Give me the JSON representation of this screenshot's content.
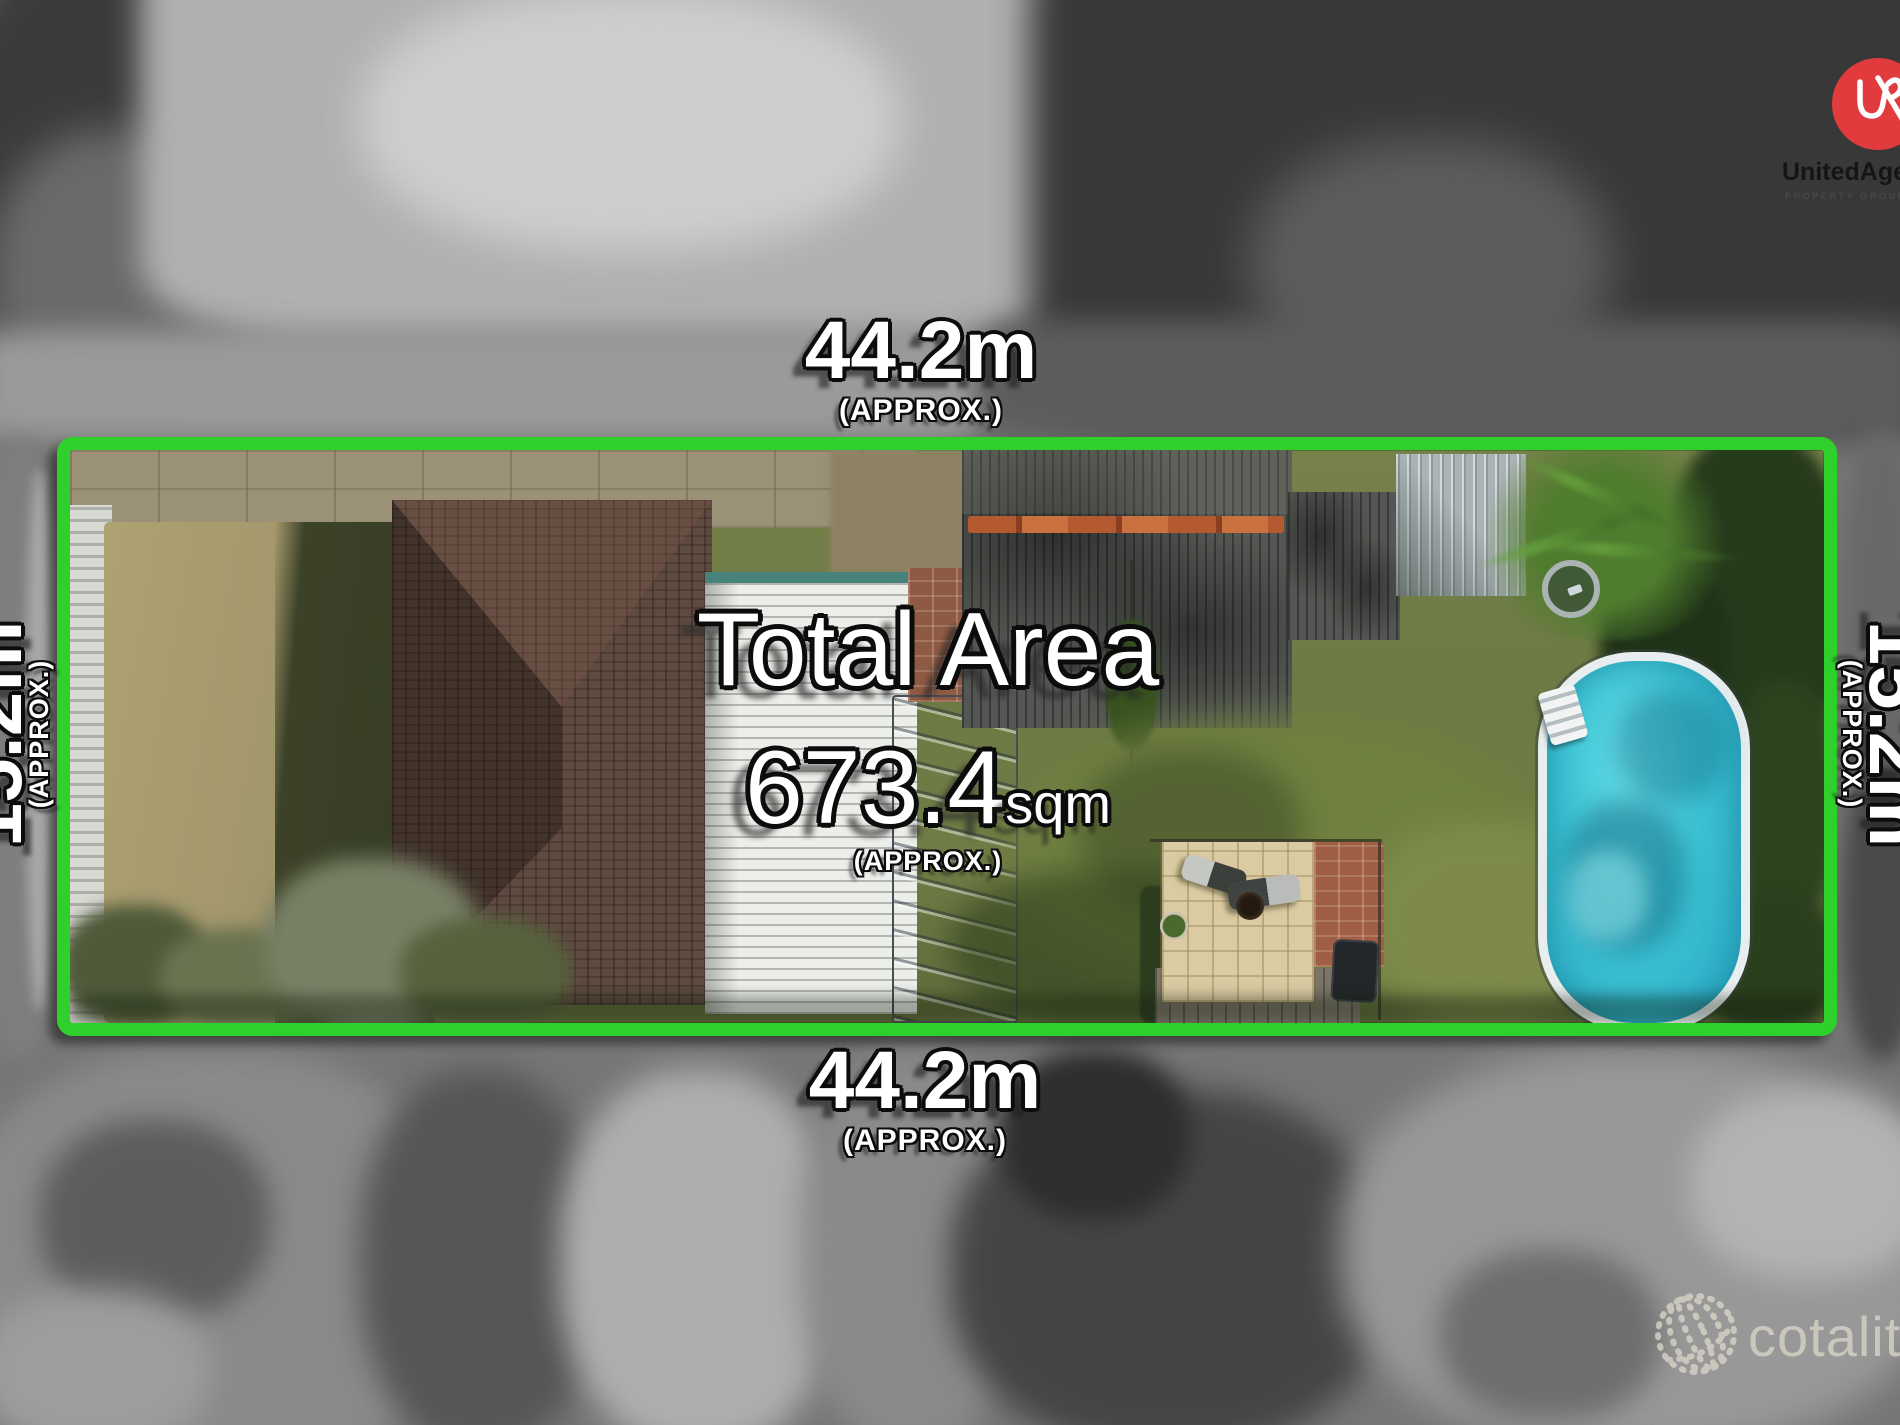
{
  "dimensions": {
    "top": {
      "value": "44.2m",
      "qualifier": "(APPROX.)"
    },
    "bottom": {
      "value": "44.2m",
      "qualifier": "(APPROX.)"
    },
    "left": {
      "value": "15.2m",
      "qualifier": "(APPROX.)"
    },
    "right": {
      "value": "15.2m",
      "qualifier": "(APPROX.)"
    }
  },
  "total_area": {
    "title": "Total Area",
    "value": "673.4",
    "unit": "sqm",
    "qualifier": "(APPROX.)"
  },
  "agency": {
    "name": "UnitedAgents",
    "tagline": "PROPERTY GROUP"
  },
  "watermark": {
    "name": "cotality"
  },
  "colors": {
    "boundary_green": "#30d02c",
    "pool_water": "#3fc5d6",
    "agency_red": "#e23b3e",
    "dry_grass": "#a2966b",
    "lawn_green": "#6d7a44"
  }
}
